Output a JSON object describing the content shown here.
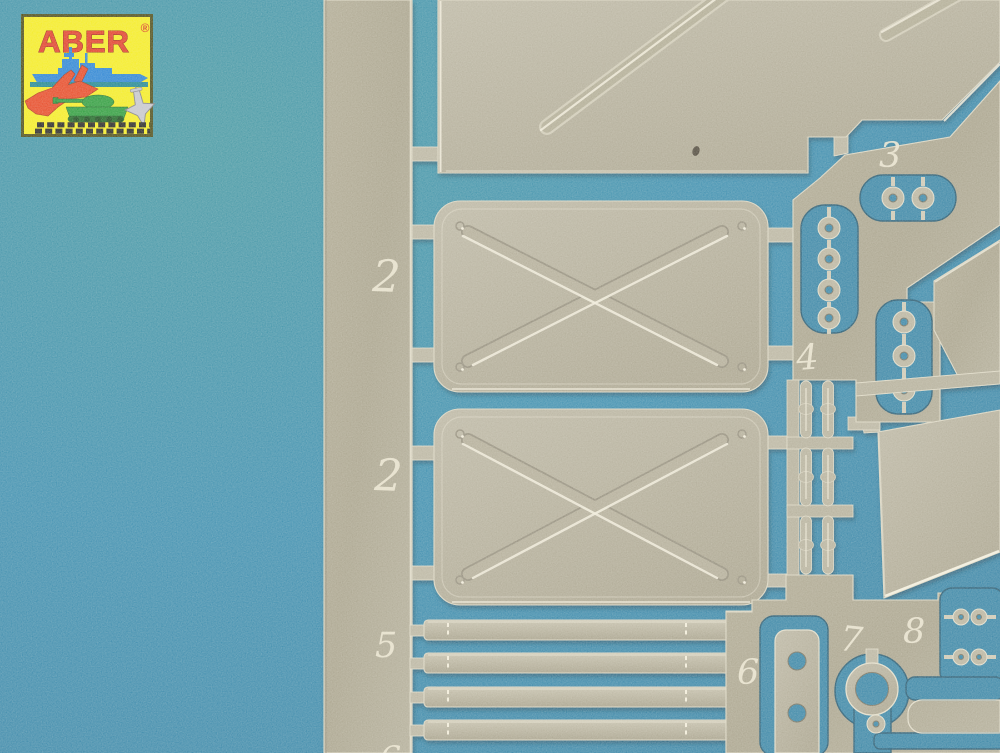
{
  "scene": {
    "type": "product-photo",
    "subject": "ABER photo-etched brass detail fret photographed on a blue background",
    "background_color": "#2f87ac",
    "metal_color": "#aaa48e",
    "cutout_color": "#2a7da2"
  },
  "logo": {
    "brand": "ABER",
    "registered_mark": "®",
    "box_color": "#f5ec12",
    "brand_color": "#e0301a",
    "icons": [
      "battleship-icon",
      "jet-fighter-icon",
      "tank-icon",
      "aircraft-icon"
    ]
  },
  "fret": {
    "part_numbers": {
      "upper_plate": "2",
      "lower_plate": "2",
      "disc_pairs": "3",
      "chain_links": "4",
      "flat_strips": "5",
      "holed_bracket": "6",
      "ring": "7",
      "small_clasps": "8",
      "partial_bottom_edge": "6"
    }
  }
}
